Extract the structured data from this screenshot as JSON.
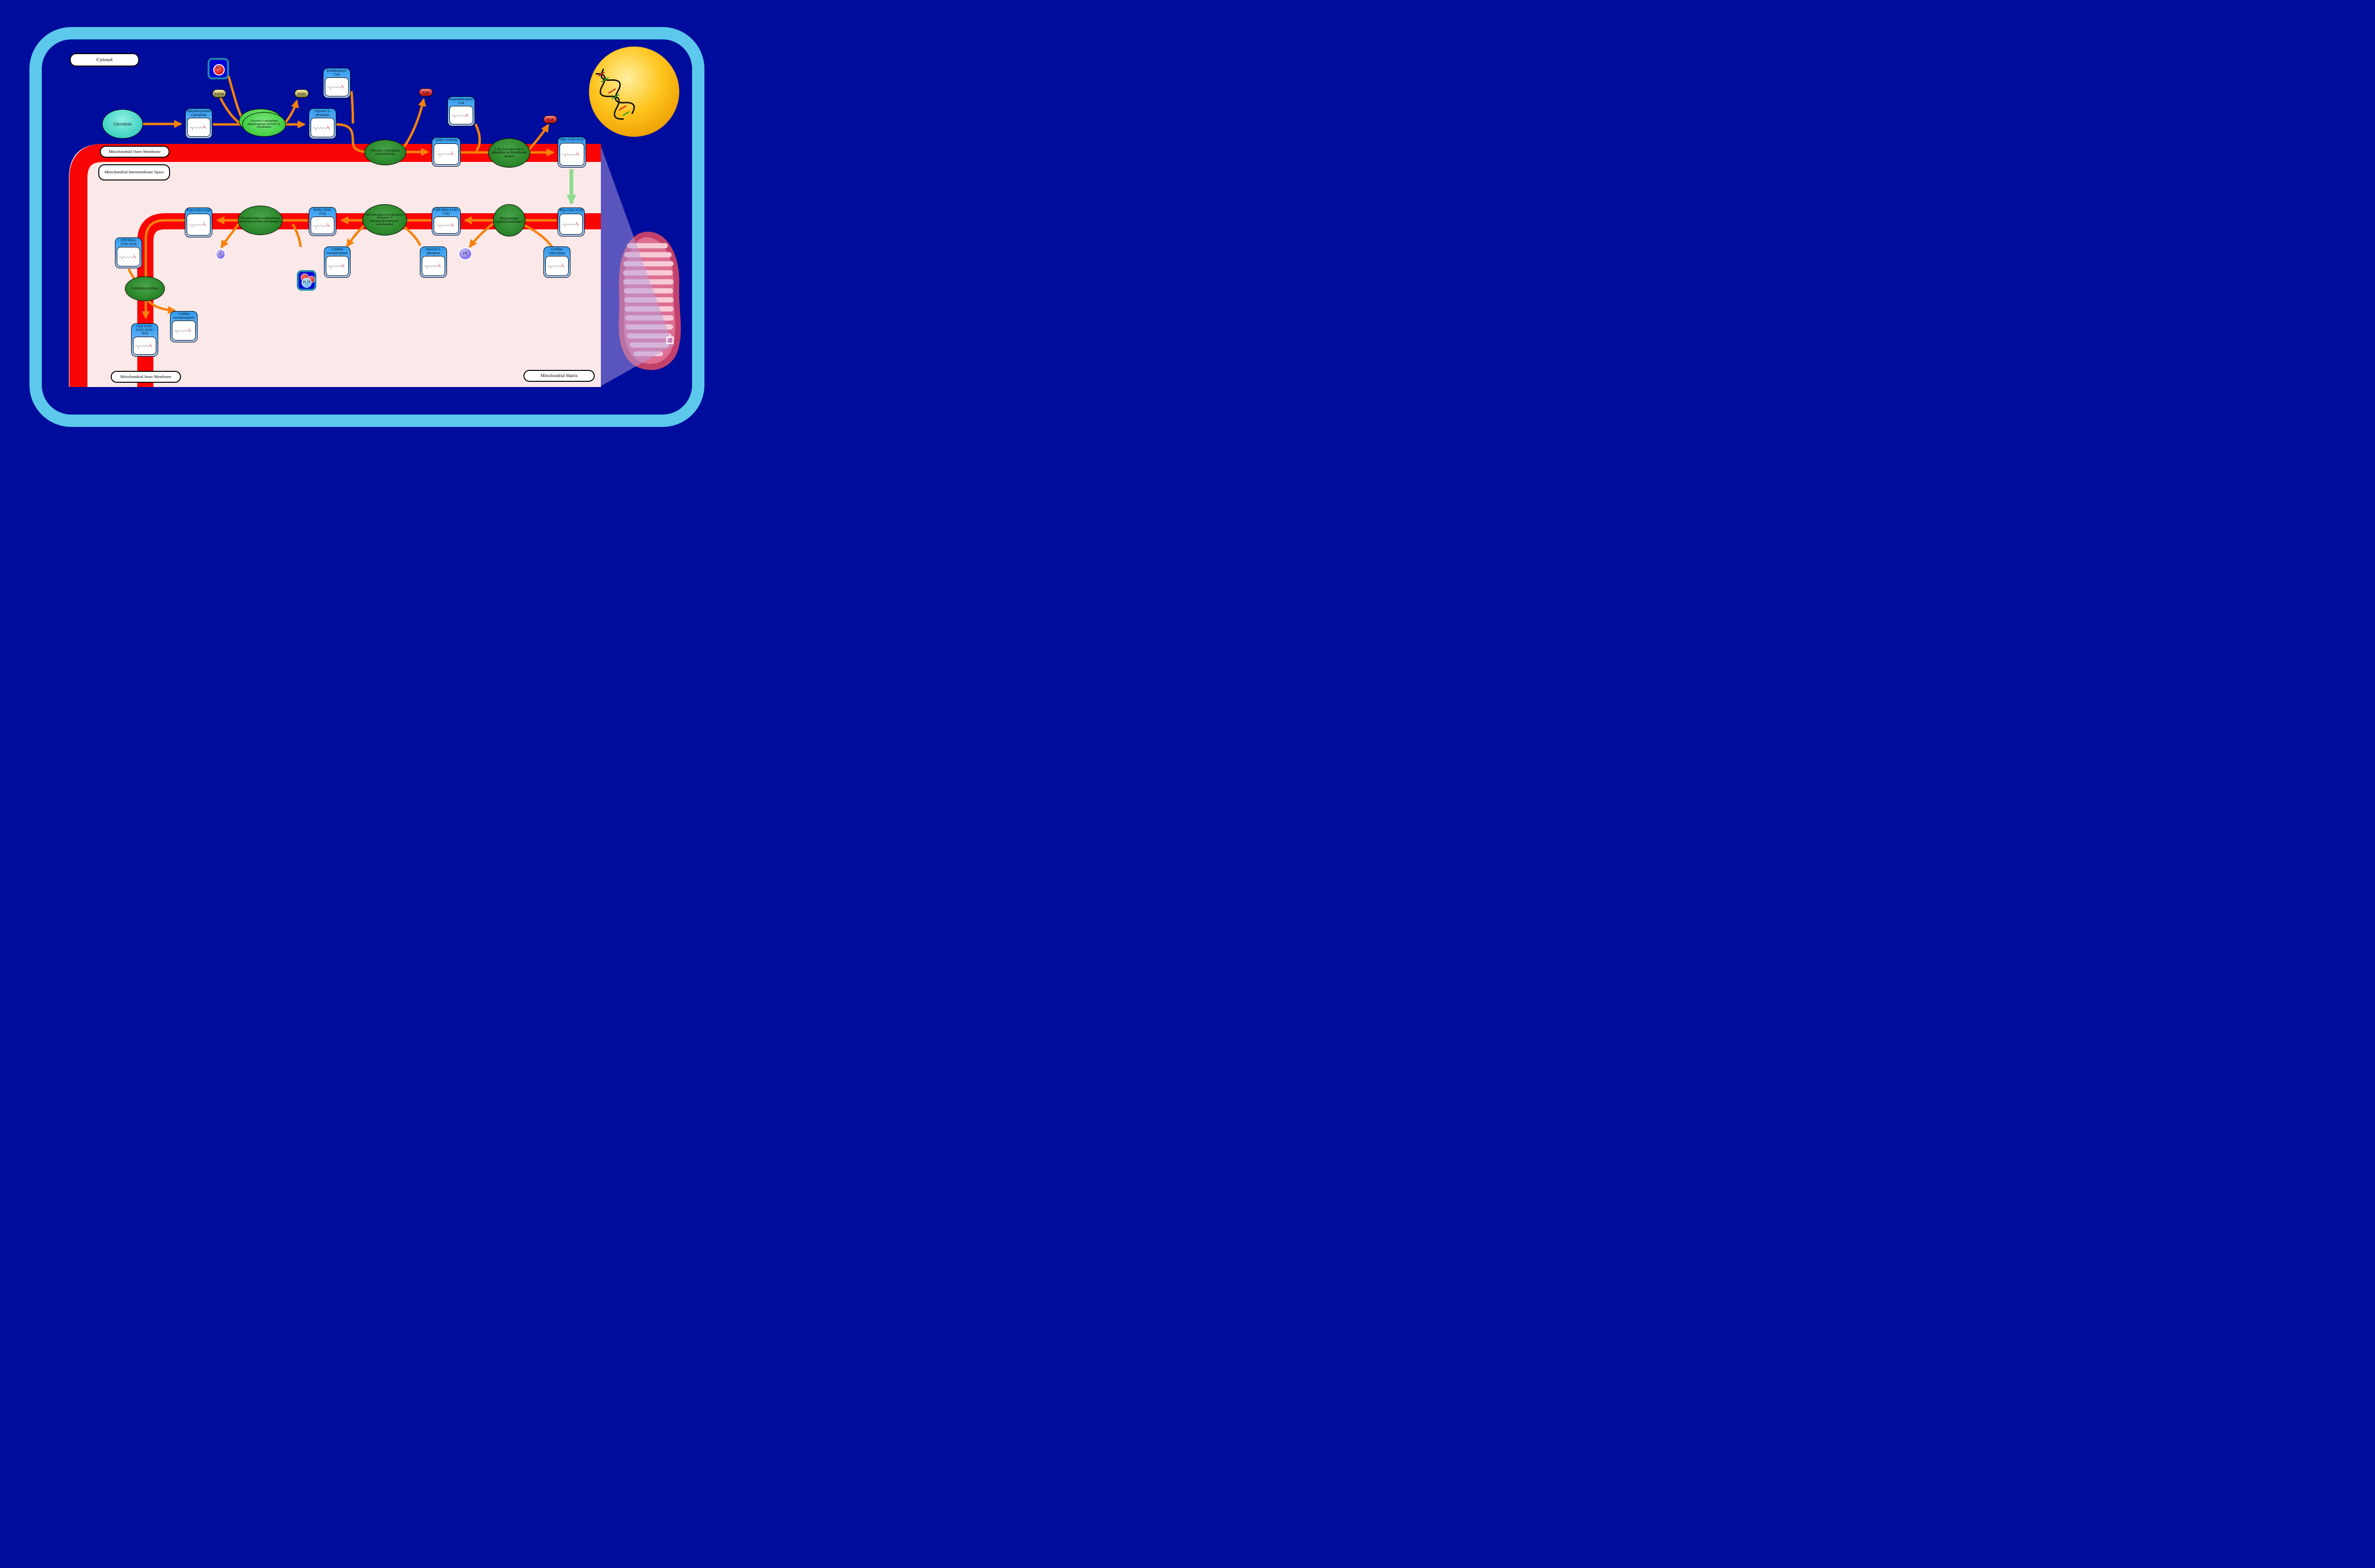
{
  "title": "Cardiolipin biosynthesis pathway",
  "colors": {
    "background_navy": "#000d9c",
    "cell_border_blue": "#5bc8ec",
    "membrane_red": "#fa0505",
    "intermembrane_pink": "#fbe8e8",
    "arrow_orange": "#f5820b",
    "arrow_green": "#8fdc8f",
    "enzyme_green": "#2e8b2e",
    "metabolite_blue": "#2f9bf0",
    "nad_olive": "#cfc67a",
    "coa_red": "#d93030",
    "phosphate_purple": "#5e4fe0",
    "nucleus_gold": "#ffc215",
    "mitochondrion_crimson": "#c2416b"
  },
  "compartments": {
    "cytosol": "Cytosol",
    "outer_membrane": "Mitochondrial Outer Membrane",
    "intermembrane_space": "Mitochondrial Intermembrane Space",
    "inner_membrane": "Mitochondrial Inner Membrane",
    "matrix": "Mitochondrial Matrix"
  },
  "process": {
    "glycolysis": "Glycolysis"
  },
  "metabolites": {
    "dhap": "Dihydroxyacetone phosphate",
    "g3p_cytosol": "Glycerol 3-phosphate",
    "isotridecanoyl_coa": "Isotridecanoyl-CoA",
    "isopentadecanoyl_coa": "Isopentadecanoyl-CoA",
    "lpa": "LPA(i-13:0/0:0)",
    "pa_outer": "PA(i-13:0/i-15:0)",
    "pa_inner": "PA(i-13:0/i-15:0)",
    "cdp_dg_1": "CDP-DG(i-13:0/i-15:0)",
    "pgp": "PGP(i-13:0/i-15:0)",
    "pg": "PG(i-13:0/i-15:0)",
    "cdp_dg_2": "CDP-DG(i-22:0/i-16:0)",
    "cl": "CL(i-13:0/i-15:0/i-22:0/i-16:0)",
    "cmp_synthase": "Cytidine monophosphate",
    "cmp_matrix": "Cytidine monophosphate",
    "g3p_matrix": "Glycerol 3-phosphate",
    "ctp": "Cytidine triphosphate"
  },
  "enzymes": {
    "gpd": "Glycerol-3-phosphate dehydrogenase [NAD(+)], cytoplasmic",
    "gpat": "Glycerol-3-phosphate acyltransferase",
    "agpat": "1-Acyl-sn-glycerol-3-phosphate acyltransferase epsilon",
    "pct2": "Phosphatidate cytidylyltransferase 2",
    "cds": "CDP-diacylglycerol--glycerol-3-phosphate 3-phosphatidyltransferase, mitochondrial",
    "pgphos": "Phosphatidylglycerophosphatase and protein-tyrosine phosphatase 1",
    "clsyn": "Cardiolipin synthase"
  },
  "cofactors": {
    "nadh": "NADH",
    "nad": "NAD",
    "coa_1": "CoA",
    "coa_2": "CoA"
  },
  "ions": {
    "proton": {
      "symbol": "H",
      "charge": "+"
    },
    "water": {
      "h": "H",
      "sub": "2",
      "o": "O"
    },
    "pi": {
      "p": "P",
      "sub": "i"
    },
    "ppi": {
      "pp": "PP",
      "sub": "i"
    }
  }
}
